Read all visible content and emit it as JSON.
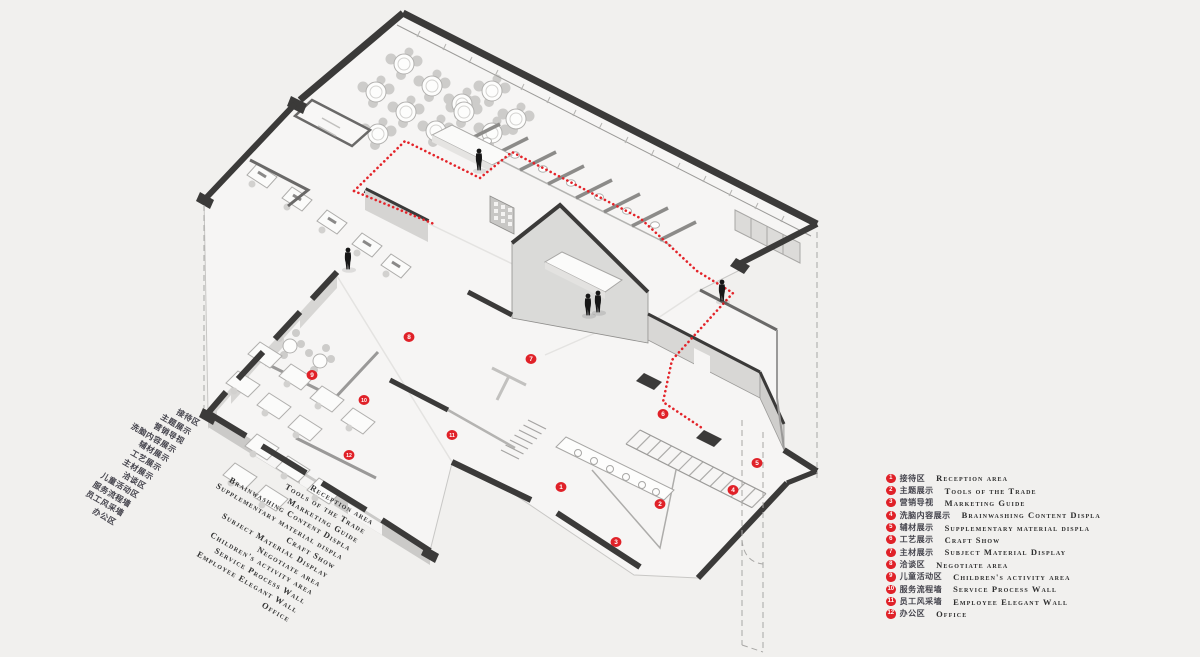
{
  "legend": {
    "items": [
      {
        "num": "1",
        "zh": "接待区",
        "en": "Reception area"
      },
      {
        "num": "2",
        "zh": "主题展示",
        "en": "Tools of the Trade"
      },
      {
        "num": "3",
        "zh": "营销导视",
        "en": "Marketing Guide"
      },
      {
        "num": "4",
        "zh": "洗脑内容展示",
        "en": "Brainwashing Content Displa"
      },
      {
        "num": "5",
        "zh": "辅材展示",
        "en": "Supplementary material displa"
      },
      {
        "num": "6",
        "zh": "工艺展示",
        "en": "Craft Show"
      },
      {
        "num": "7",
        "zh": "主材展示",
        "en": "Subject Material Display"
      },
      {
        "num": "8",
        "zh": "洽谈区",
        "en": "Negotiate area"
      },
      {
        "num": "9",
        "zh": "儿童活动区",
        "en": "Children's activity area"
      },
      {
        "num": "10",
        "zh": "服务流程墙",
        "en": "Service Process Wall"
      },
      {
        "num": "11",
        "zh": "员工风采墙",
        "en": "Employee Elegant Wall"
      },
      {
        "num": "12",
        "zh": "办公区",
        "en": "Office"
      }
    ]
  },
  "colors": {
    "accent_red": "#e02128",
    "wall_dark": "#3b3a39",
    "background": "#f1f0ee"
  }
}
